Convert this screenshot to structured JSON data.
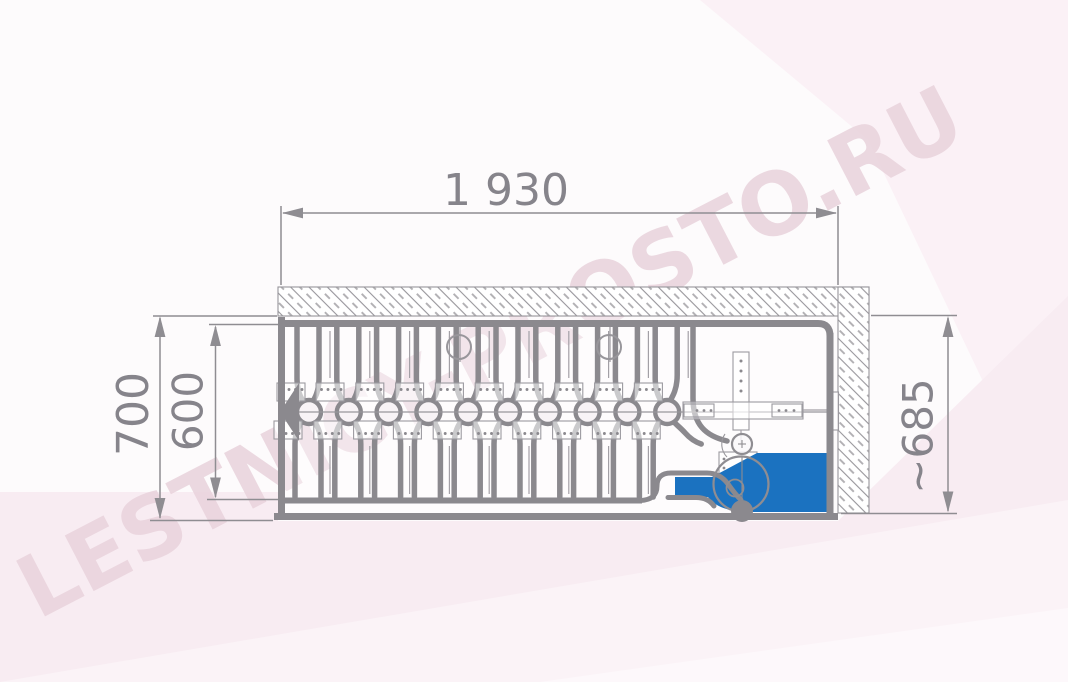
{
  "diagram": {
    "type": "technical-drawing-plan-view-folded-attic-ladder",
    "watermark": {
      "text": "LESTNICY-PROSTO.RU"
    },
    "dimensions": {
      "length": {
        "label": "1 930"
      },
      "width_outer": {
        "label": "700"
      },
      "width_inner": {
        "label": "600"
      },
      "depth": {
        "label": "~685"
      }
    },
    "mechanism": {
      "hinge_count": 10,
      "hinge_start_x": 309,
      "hinge_spacing": 39.8,
      "axis_y": 412,
      "spring_hanger_xs": [
        459,
        609
      ],
      "highlight_part": "lock-spring-block"
    },
    "colors": {
      "line": "#8b898e",
      "thin_line": "#a3a0a6",
      "dim_line": "#8f8d92",
      "label_text": "#86848b",
      "accent_blue": "#1b72c0",
      "plate_stroke": "#9c9aa0",
      "plate_fill": "rgba(255,255,255,0.55)",
      "hinge_fill": "#f8f3f6",
      "hatch_line": "#97959a",
      "bg_base": "#fdfbfc",
      "bg_tint": "#f8ecf2",
      "bg_tint_light": "#fbf3f7",
      "bg_tint_top": "#fbf1f6",
      "bg_tint_bottom": "#fdf8fb",
      "watermark": "#e9d3dc"
    }
  }
}
